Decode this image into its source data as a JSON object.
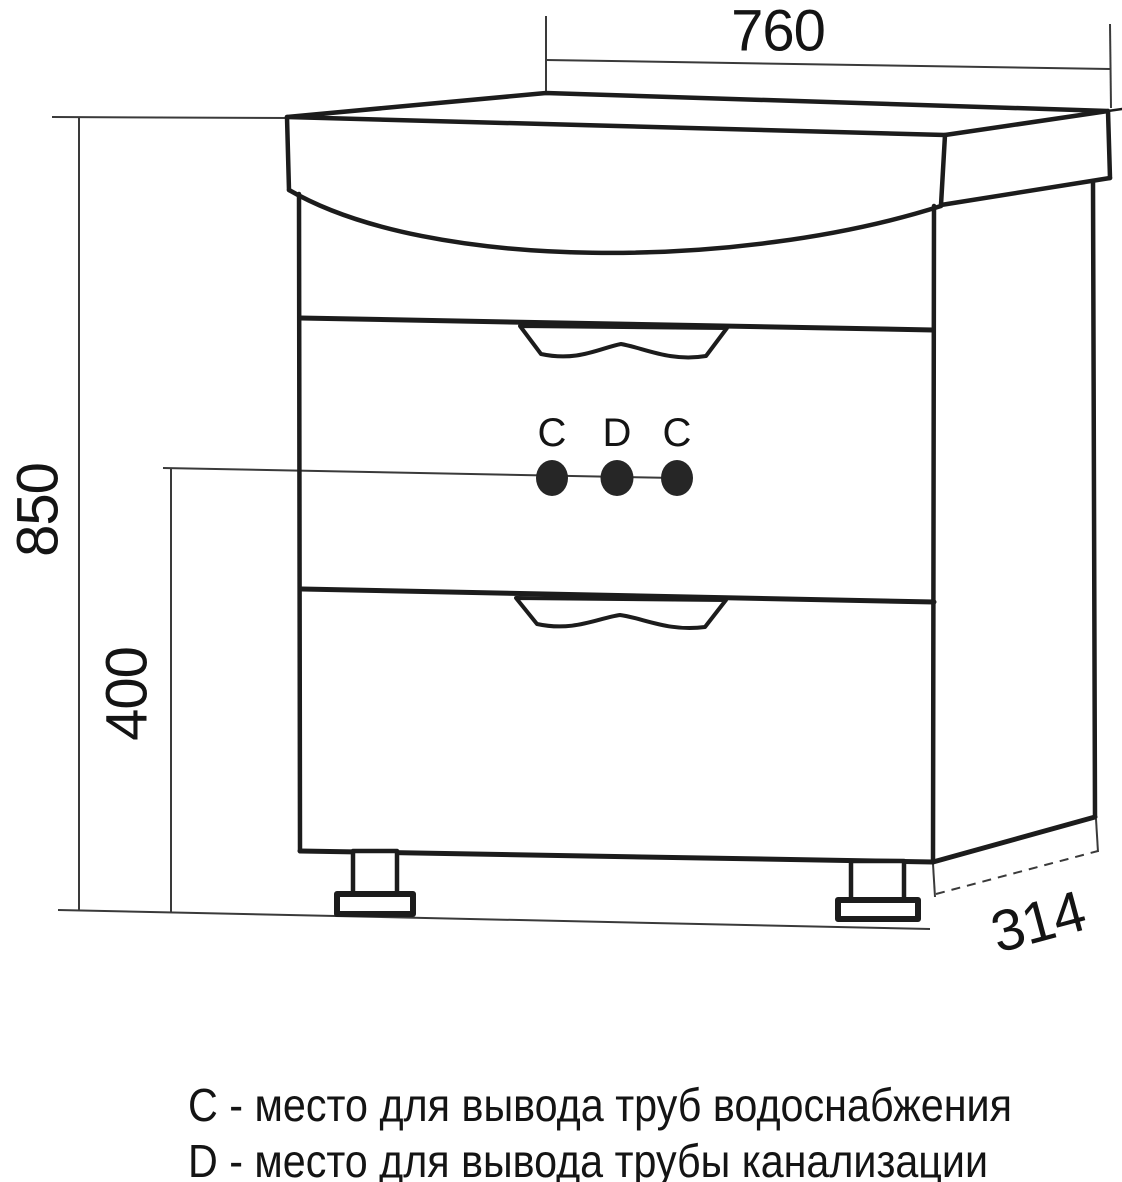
{
  "diagram": {
    "dimensions": {
      "width": "760",
      "height": "850",
      "holes_height": "400",
      "depth": "314"
    },
    "markers": [
      "C",
      "D",
      "C"
    ],
    "legend": [
      "C - место для вывода труб водоснабжения",
      "D - место для вывода трубы канализации"
    ],
    "colors": {
      "line": "#1c1c1c",
      "dimension_line": "#3a3a3a",
      "marker_fill": "#262626",
      "background": "#ffffff"
    }
  }
}
